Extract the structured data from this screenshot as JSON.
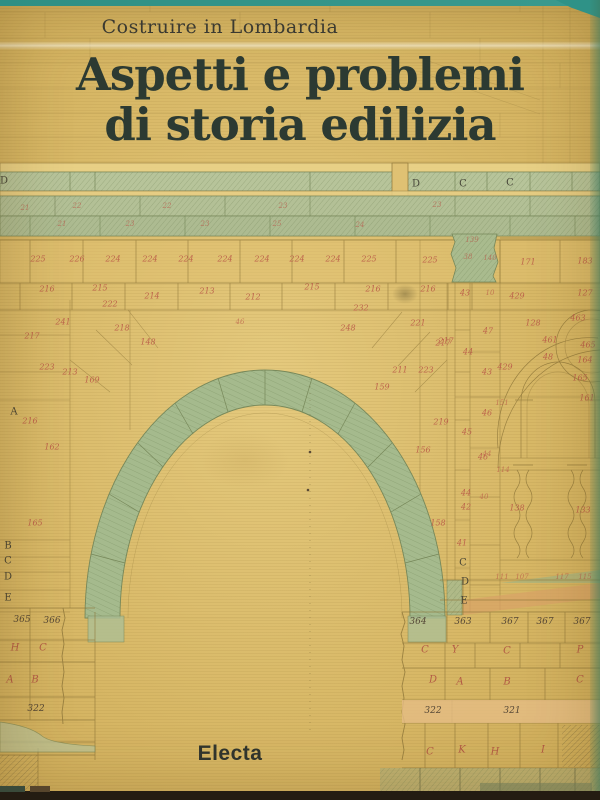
{
  "cover": {
    "series": "Costruire in Lombardia",
    "title_line1": "Aspetti e problemi",
    "title_line2": "di storia edilizia",
    "publisher": "Electa"
  },
  "colors": {
    "teal": "#2f9287",
    "paper": "#d7b765",
    "paper_light": "#e5ca7e",
    "band_green": "#b5c294",
    "arch_green": "#a5ba8d",
    "red": "#b85446",
    "title": "#2c3a32"
  },
  "drawing": {
    "description": "architectural survey drawing of a stone arch with numbered voussoirs",
    "annotations": [
      {
        "t": "D",
        "x": 4,
        "y": 181,
        "k": "k-d"
      },
      {
        "t": "D",
        "x": 416,
        "y": 184,
        "k": "k-d"
      },
      {
        "t": "C",
        "x": 463,
        "y": 184,
        "k": "k-d"
      },
      {
        "t": "C",
        "x": 510,
        "y": 183,
        "k": "k-d"
      },
      {
        "t": "21",
        "x": 25,
        "y": 208,
        "k": "k-rs"
      },
      {
        "t": "22",
        "x": 77,
        "y": 206,
        "k": "k-rs"
      },
      {
        "t": "22",
        "x": 167,
        "y": 206,
        "k": "k-rs"
      },
      {
        "t": "23",
        "x": 283,
        "y": 206,
        "k": "k-rs"
      },
      {
        "t": "23",
        "x": 437,
        "y": 205,
        "k": "k-rs"
      },
      {
        "t": "21",
        "x": 62,
        "y": 224,
        "k": "k-rs"
      },
      {
        "t": "23",
        "x": 130,
        "y": 224,
        "k": "k-rs"
      },
      {
        "t": "23",
        "x": 205,
        "y": 224,
        "k": "k-rs"
      },
      {
        "t": "25",
        "x": 277,
        "y": 224,
        "k": "k-rs"
      },
      {
        "t": "24",
        "x": 360,
        "y": 225,
        "k": "k-rs"
      },
      {
        "t": "225",
        "x": 38,
        "y": 259,
        "k": "k-r"
      },
      {
        "t": "226",
        "x": 77,
        "y": 259,
        "k": "k-r"
      },
      {
        "t": "224",
        "x": 113,
        "y": 259,
        "k": "k-r"
      },
      {
        "t": "224",
        "x": 150,
        "y": 259,
        "k": "k-r"
      },
      {
        "t": "224",
        "x": 186,
        "y": 259,
        "k": "k-r"
      },
      {
        "t": "224",
        "x": 225,
        "y": 259,
        "k": "k-r"
      },
      {
        "t": "224",
        "x": 262,
        "y": 259,
        "k": "k-r"
      },
      {
        "t": "224",
        "x": 297,
        "y": 259,
        "k": "k-r"
      },
      {
        "t": "224",
        "x": 333,
        "y": 259,
        "k": "k-r"
      },
      {
        "t": "225",
        "x": 369,
        "y": 259,
        "k": "k-r"
      },
      {
        "t": "139",
        "x": 472,
        "y": 240,
        "k": "k-rs"
      },
      {
        "t": "171",
        "x": 528,
        "y": 262,
        "k": "k-r"
      },
      {
        "t": "183",
        "x": 585,
        "y": 261,
        "k": "k-r"
      },
      {
        "t": "225",
        "x": 430,
        "y": 260,
        "k": "k-r"
      },
      {
        "t": "38",
        "x": 468,
        "y": 257,
        "k": "k-rs"
      },
      {
        "t": "140",
        "x": 490,
        "y": 258,
        "k": "k-rs"
      },
      {
        "t": "216",
        "x": 47,
        "y": 289,
        "k": "k-r"
      },
      {
        "t": "215",
        "x": 100,
        "y": 288,
        "k": "k-r"
      },
      {
        "t": "214",
        "x": 152,
        "y": 296,
        "k": "k-r"
      },
      {
        "t": "213",
        "x": 207,
        "y": 291,
        "k": "k-r"
      },
      {
        "t": "212",
        "x": 253,
        "y": 297,
        "k": "k-r"
      },
      {
        "t": "215",
        "x": 312,
        "y": 287,
        "k": "k-r"
      },
      {
        "t": "216",
        "x": 373,
        "y": 289,
        "k": "k-r"
      },
      {
        "t": "216",
        "x": 428,
        "y": 289,
        "k": "k-r"
      },
      {
        "t": "43",
        "x": 465,
        "y": 293,
        "k": "k-r"
      },
      {
        "t": "10",
        "x": 490,
        "y": 293,
        "k": "k-rs"
      },
      {
        "t": "429",
        "x": 517,
        "y": 296,
        "k": "k-r"
      },
      {
        "t": "127",
        "x": 585,
        "y": 293,
        "k": "k-r"
      },
      {
        "t": "222",
        "x": 110,
        "y": 304,
        "k": "k-r"
      },
      {
        "t": "241",
        "x": 63,
        "y": 322,
        "k": "k-r"
      },
      {
        "t": "218",
        "x": 122,
        "y": 328,
        "k": "k-r"
      },
      {
        "t": "217",
        "x": 32,
        "y": 336,
        "k": "k-r"
      },
      {
        "t": "223",
        "x": 47,
        "y": 367,
        "k": "k-r"
      },
      {
        "t": "213",
        "x": 70,
        "y": 372,
        "k": "k-r"
      },
      {
        "t": "232",
        "x": 361,
        "y": 308,
        "k": "k-r"
      },
      {
        "t": "221",
        "x": 418,
        "y": 323,
        "k": "k-r"
      },
      {
        "t": "248",
        "x": 348,
        "y": 328,
        "k": "k-r"
      },
      {
        "t": "217",
        "x": 446,
        "y": 341,
        "k": "k-r"
      },
      {
        "t": "211",
        "x": 400,
        "y": 370,
        "k": "k-r"
      },
      {
        "t": "223",
        "x": 426,
        "y": 370,
        "k": "k-r"
      },
      {
        "t": "46",
        "x": 240,
        "y": 322,
        "k": "k-rs"
      },
      {
        "t": "148",
        "x": 148,
        "y": 342,
        "k": "k-r"
      },
      {
        "t": "169",
        "x": 92,
        "y": 380,
        "k": "k-r"
      },
      {
        "t": "159",
        "x": 382,
        "y": 387,
        "k": "k-r"
      },
      {
        "t": "156",
        "x": 423,
        "y": 450,
        "k": "k-r"
      },
      {
        "t": "158",
        "x": 438,
        "y": 523,
        "k": "k-r"
      },
      {
        "t": "162",
        "x": 52,
        "y": 447,
        "k": "k-r"
      },
      {
        "t": "165",
        "x": 35,
        "y": 523,
        "k": "k-r"
      },
      {
        "t": "A",
        "x": 14,
        "y": 412,
        "k": "k-d"
      },
      {
        "t": "216",
        "x": 30,
        "y": 421,
        "k": "k-r"
      },
      {
        "t": "B",
        "x": 8,
        "y": 546,
        "k": "k-d"
      },
      {
        "t": "C",
        "x": 8,
        "y": 561,
        "k": "k-d"
      },
      {
        "t": "D",
        "x": 8,
        "y": 577,
        "k": "k-d"
      },
      {
        "t": "E",
        "x": 8,
        "y": 598,
        "k": "k-d"
      },
      {
        "t": "219",
        "x": 441,
        "y": 422,
        "k": "k-r"
      },
      {
        "t": "217",
        "x": 443,
        "y": 343,
        "k": "k-r"
      },
      {
        "t": "47",
        "x": 488,
        "y": 331,
        "k": "k-r"
      },
      {
        "t": "44",
        "x": 468,
        "y": 352,
        "k": "k-r"
      },
      {
        "t": "43",
        "x": 487,
        "y": 372,
        "k": "k-r"
      },
      {
        "t": "429",
        "x": 505,
        "y": 367,
        "k": "k-r"
      },
      {
        "t": "45",
        "x": 467,
        "y": 432,
        "k": "k-r"
      },
      {
        "t": "46",
        "x": 483,
        "y": 457,
        "k": "k-r"
      },
      {
        "t": "44",
        "x": 466,
        "y": 493,
        "k": "k-r"
      },
      {
        "t": "40",
        "x": 484,
        "y": 497,
        "k": "k-rs"
      },
      {
        "t": "42",
        "x": 466,
        "y": 507,
        "k": "k-r"
      },
      {
        "t": "41",
        "x": 462,
        "y": 543,
        "k": "k-r"
      },
      {
        "t": "114",
        "x": 503,
        "y": 470,
        "k": "k-rs"
      },
      {
        "t": "138",
        "x": 517,
        "y": 508,
        "k": "k-r"
      },
      {
        "t": "133",
        "x": 583,
        "y": 510,
        "k": "k-r"
      },
      {
        "t": "128",
        "x": 533,
        "y": 323,
        "k": "k-r"
      },
      {
        "t": "463",
        "x": 578,
        "y": 318,
        "k": "k-r"
      },
      {
        "t": "461",
        "x": 550,
        "y": 340,
        "k": "k-r"
      },
      {
        "t": "465",
        "x": 588,
        "y": 345,
        "k": "k-r"
      },
      {
        "t": "48",
        "x": 548,
        "y": 357,
        "k": "k-r"
      },
      {
        "t": "164",
        "x": 585,
        "y": 360,
        "k": "k-r"
      },
      {
        "t": "165",
        "x": 580,
        "y": 378,
        "k": "k-r"
      },
      {
        "t": "161",
        "x": 587,
        "y": 398,
        "k": "k-r"
      },
      {
        "t": "151",
        "x": 502,
        "y": 403,
        "k": "k-rs"
      },
      {
        "t": "46",
        "x": 487,
        "y": 413,
        "k": "k-r"
      },
      {
        "t": "44",
        "x": 487,
        "y": 454,
        "k": "k-rs"
      },
      {
        "t": "111",
        "x": 502,
        "y": 577,
        "k": "k-rs"
      },
      {
        "t": "107",
        "x": 522,
        "y": 577,
        "k": "k-rs"
      },
      {
        "t": "117",
        "x": 562,
        "y": 577,
        "k": "k-rs"
      },
      {
        "t": "115",
        "x": 585,
        "y": 577,
        "k": "k-rs"
      },
      {
        "t": "C",
        "x": 463,
        "y": 563,
        "k": "k-d"
      },
      {
        "t": "D",
        "x": 465,
        "y": 582,
        "k": "k-d"
      },
      {
        "t": "E",
        "x": 464,
        "y": 601,
        "k": "k-d"
      },
      {
        "t": "364",
        "x": 418,
        "y": 622,
        "k": "k-dn"
      },
      {
        "t": "363",
        "x": 463,
        "y": 622,
        "k": "k-dn"
      },
      {
        "t": "367",
        "x": 510,
        "y": 622,
        "k": "k-dn"
      },
      {
        "t": "367",
        "x": 545,
        "y": 622,
        "k": "k-dn"
      },
      {
        "t": "367",
        "x": 582,
        "y": 622,
        "k": "k-dn"
      },
      {
        "t": "C",
        "x": 425,
        "y": 650,
        "k": "k-rl"
      },
      {
        "t": "Y",
        "x": 455,
        "y": 650,
        "k": "k-rl"
      },
      {
        "t": "C",
        "x": 507,
        "y": 651,
        "k": "k-rl"
      },
      {
        "t": "P",
        "x": 580,
        "y": 650,
        "k": "k-rl"
      },
      {
        "t": "D",
        "x": 433,
        "y": 680,
        "k": "k-rl"
      },
      {
        "t": "A",
        "x": 460,
        "y": 682,
        "k": "k-rl"
      },
      {
        "t": "B",
        "x": 507,
        "y": 682,
        "k": "k-rl"
      },
      {
        "t": "C",
        "x": 580,
        "y": 680,
        "k": "k-rl"
      },
      {
        "t": "322",
        "x": 433,
        "y": 711,
        "k": "k-dn"
      },
      {
        "t": "321",
        "x": 512,
        "y": 711,
        "k": "k-dn"
      },
      {
        "t": "C",
        "x": 430,
        "y": 752,
        "k": "k-rl"
      },
      {
        "t": "K",
        "x": 462,
        "y": 750,
        "k": "k-rl"
      },
      {
        "t": "H",
        "x": 495,
        "y": 752,
        "k": "k-rl"
      },
      {
        "t": "I",
        "x": 543,
        "y": 750,
        "k": "k-rl"
      },
      {
        "t": "365",
        "x": 22,
        "y": 620,
        "k": "k-dn"
      },
      {
        "t": "366",
        "x": 52,
        "y": 621,
        "k": "k-dn"
      },
      {
        "t": "H",
        "x": 15,
        "y": 648,
        "k": "k-rl"
      },
      {
        "t": "C",
        "x": 43,
        "y": 648,
        "k": "k-rl"
      },
      {
        "t": "A",
        "x": 10,
        "y": 680,
        "k": "k-rl"
      },
      {
        "t": "B",
        "x": 35,
        "y": 680,
        "k": "k-rl"
      },
      {
        "t": "322",
        "x": 36,
        "y": 709,
        "k": "k-dn"
      }
    ]
  }
}
